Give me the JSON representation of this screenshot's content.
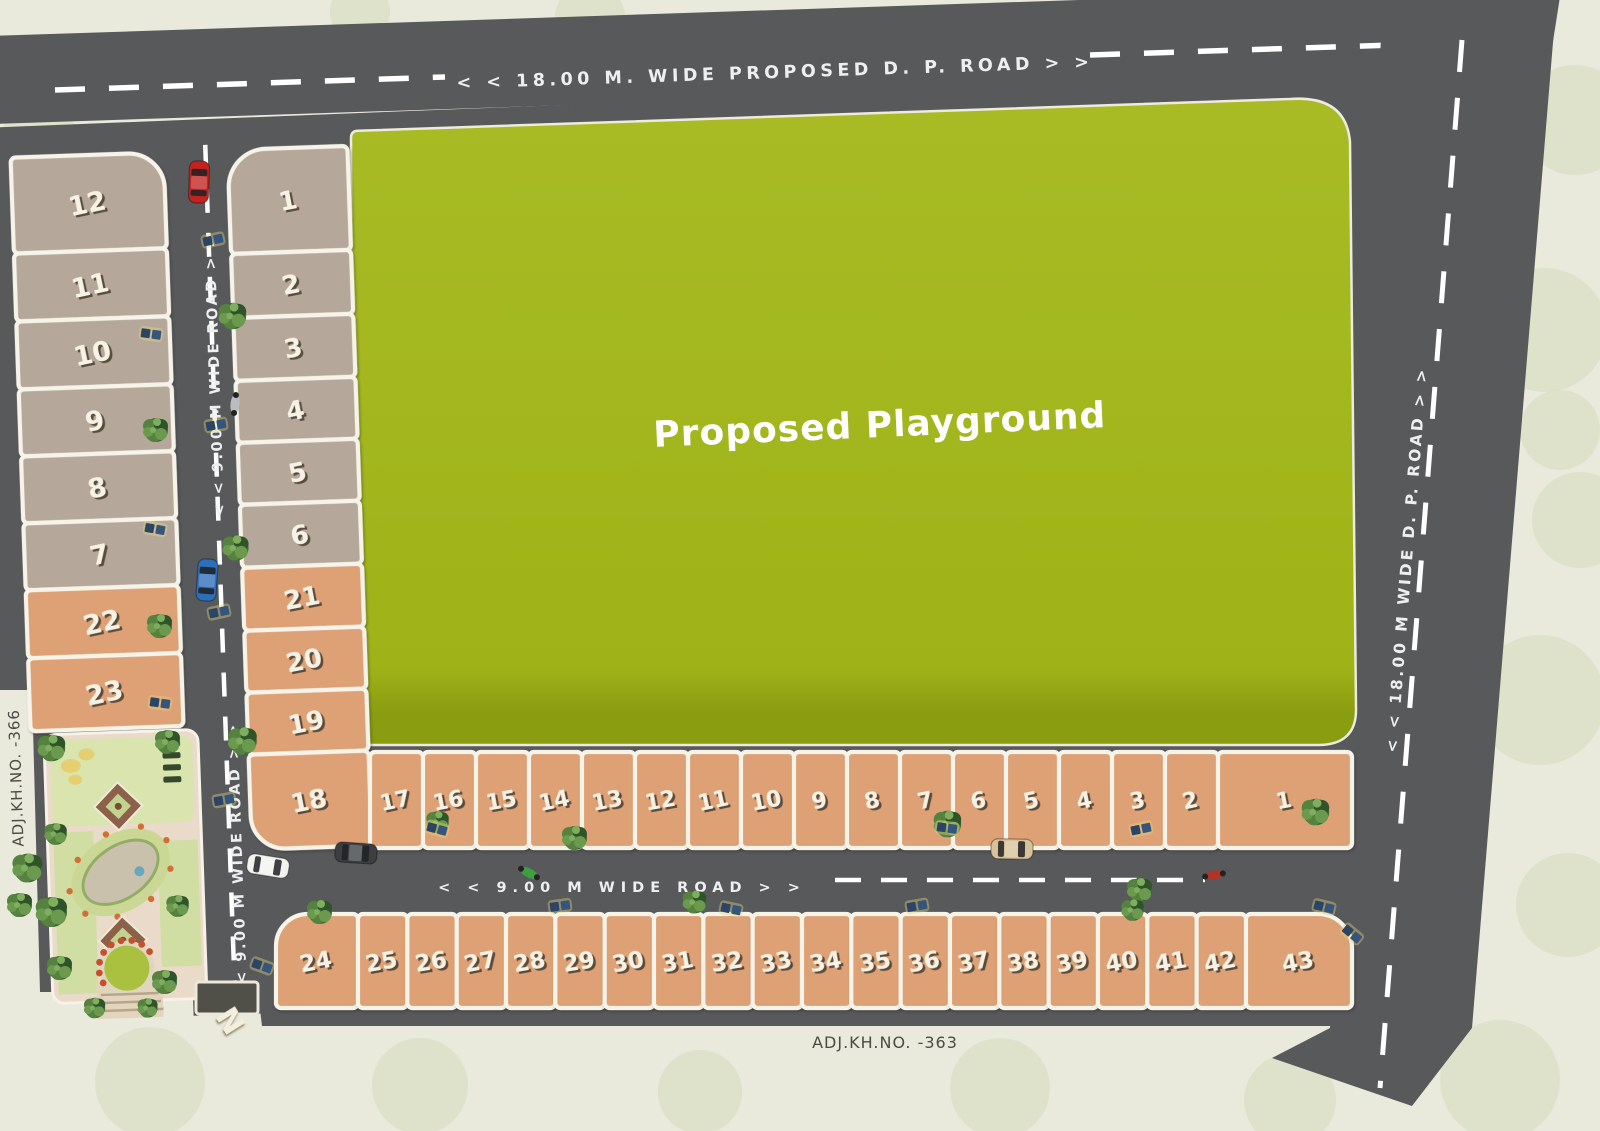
{
  "title": "Plot layout site plan",
  "colors": {
    "road_gray": "#58595b",
    "playground_green": "#a3b71e",
    "playground_dark": "#8a9c10",
    "plot_taupe": "#b5a89b",
    "plot_orange": "#dda174",
    "plot_border": "#f6f3e9",
    "background_cream": "#e9e9dc",
    "number_cream": "#f7f2e6"
  },
  "roads": {
    "top": {
      "label": "< <  18.00 M.  WIDE PROPOSED D.  P. ROAD  > >"
    },
    "right": {
      "label": "< < 18.00 M  WIDE  D.  P. ROAD > >"
    },
    "left_upper": {
      "label": "< < 9.00 M WIDE  ROAD > >"
    },
    "left_lower": {
      "label": "< < 9.00 M WIDE  ROAD > >"
    },
    "middle": {
      "label": "< < 9.00   M WIDE   ROAD > >"
    }
  },
  "playground": {
    "label": "Proposed Playground"
  },
  "annotations": {
    "adj_left": "ADJ.KH.NO. -366",
    "adj_bottom": "ADJ.KH.NO. -363",
    "compass": "N"
  },
  "plots": {
    "left_column": [
      "12",
      "11",
      "10",
      "9",
      "8",
      "7",
      "22",
      "23"
    ],
    "inner_column": [
      "1",
      "2",
      "3",
      "4",
      "5",
      "6",
      "21",
      "20",
      "19",
      "18"
    ],
    "middle_row": [
      "17",
      "16",
      "15",
      "14",
      "13",
      "12",
      "11",
      "10",
      "9",
      "8",
      "7",
      "6",
      "5",
      "4",
      "3",
      "2",
      "1"
    ],
    "bottom_row": [
      "24",
      "25",
      "26",
      "27",
      "28",
      "29",
      "30",
      "31",
      "32",
      "33",
      "34",
      "35",
      "36",
      "37",
      "38",
      "39",
      "40",
      "41",
      "42",
      "43"
    ]
  }
}
